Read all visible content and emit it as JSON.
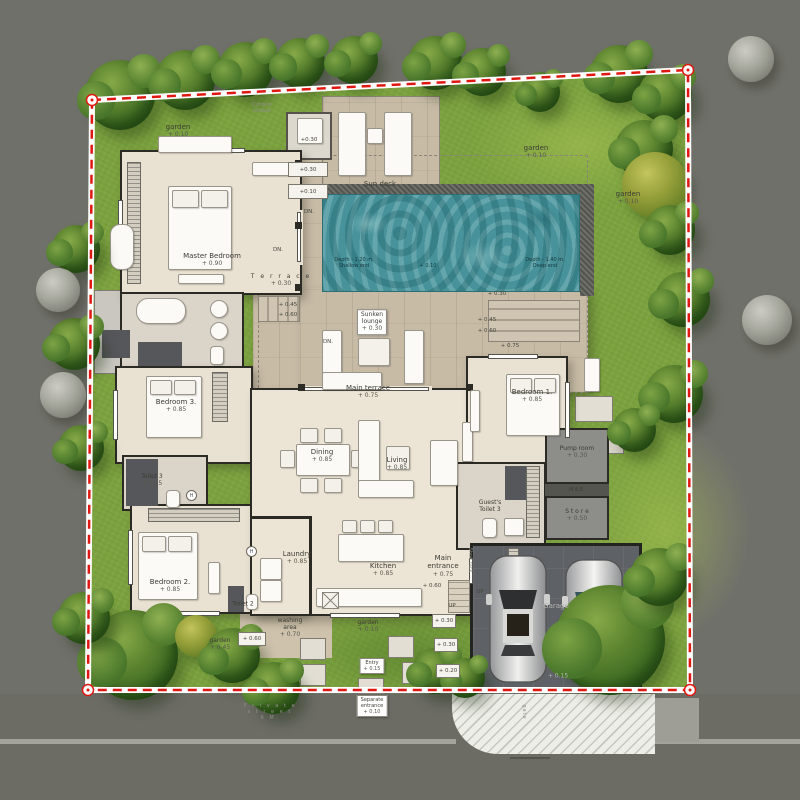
{
  "plan": {
    "rooms": {
      "master_bedroom": {
        "name": "Master Bedroom",
        "level": "+ 0.90"
      },
      "bedroom_1": {
        "name": "Bedroom 1.",
        "level": "+ 0.85"
      },
      "bedroom_2": {
        "name": "Bedroom 2.",
        "level": "+ 0.85"
      },
      "bedroom_3": {
        "name": "Bedroom 3.",
        "level": "+ 0.85"
      },
      "dining": {
        "name": "Dining",
        "level": "+ 0.85"
      },
      "living": {
        "name": "Living",
        "level": "+ 0.85"
      },
      "kitchen": {
        "name": "Kitchen",
        "level": "+ 0.85"
      },
      "laundry": {
        "name": "Laundry",
        "level": "+ 0.85"
      },
      "toilet_2": {
        "name": "Toilet 2"
      },
      "toilet_3": {
        "name": "Toilet 3",
        "level": "+ 0.85"
      },
      "guest_toilet": {
        "name": "Guest's",
        "name2": "Toilet 3"
      },
      "main_entrance": {
        "name": "Main",
        "name2": "entrance",
        "level": "+ 0.75"
      },
      "garage": {
        "name": "Garage",
        "level": "+ 0.15"
      },
      "pump_room": {
        "name": "Pump room",
        "level": "+ 0.30"
      },
      "mbe": {
        "name": "M.B.E."
      },
      "store": {
        "name": "S t o r e",
        "level": "+ 0.50"
      },
      "washing_area": {
        "name": "washing",
        "name2": "area",
        "level": "+ 0.70"
      },
      "shoe_rack": {
        "name": "Shoe rack"
      }
    },
    "outdoor": {
      "terrace": {
        "name": "T e r r a c e",
        "level": "+ 0.30"
      },
      "main_terrace": {
        "name": "Main terrace",
        "level": "+ 0.75"
      },
      "sunken_lounge": {
        "name": "Sunken",
        "name2": "lounge",
        "level": "+ 0.30"
      },
      "sun_deck": {
        "name": "Sun deck",
        "level": "+ 0.45"
      },
      "outdoor_shower": {
        "name": "Outdoor",
        "name2": "shower"
      },
      "garden_top_left": {
        "name": "garden",
        "level": "+ 0.10"
      },
      "garden_top_right": {
        "name": "garden",
        "level": "+ 0.10"
      },
      "garden_right": {
        "name": "garden",
        "level": "+ 0.10"
      },
      "garden_bottom_left": {
        "name": "garden",
        "level": "+ 0.45"
      },
      "garden_bottom_middle": {
        "name": "garden",
        "level": "+ 0.10"
      },
      "entry": {
        "name": "Entry",
        "level": "+ 0.15"
      },
      "separate_entrance": {
        "name": "Separate",
        "name2": "entrance",
        "level": "+ 0.10"
      }
    },
    "pool": {
      "depth_shallow": "Depth - 1.20 m.",
      "shallow_end": "Shallow end",
      "water_level": "+ 0.10",
      "depth_deep": "Depth - 1.40 m.",
      "deep_end": "Deep end"
    },
    "markers": {
      "pad_top_1": "+0.30",
      "pad_top_2": "+0.30",
      "pad_top_3": "+0.10",
      "deck_30": "+ 0.30",
      "deck_45": "+ 0.45",
      "deck_60": "+ 0.60",
      "deck_75": "+ 0.75",
      "west_45": "+ 0.45",
      "west_60": "+ 0.60",
      "ent_60": "+ 0.60",
      "up": "UP",
      "dn": "DN.",
      "side_30a": "+ 0.30",
      "side_30b": "+ 0.30",
      "side_20": "+ 0.20",
      "toilet2_60": "+ 0.60",
      "heater": "H"
    },
    "road": {
      "street_1": "P r i v a t e",
      "street_2": "s t r e e t",
      "street_3": "6 M.",
      "gate": "gate"
    }
  }
}
